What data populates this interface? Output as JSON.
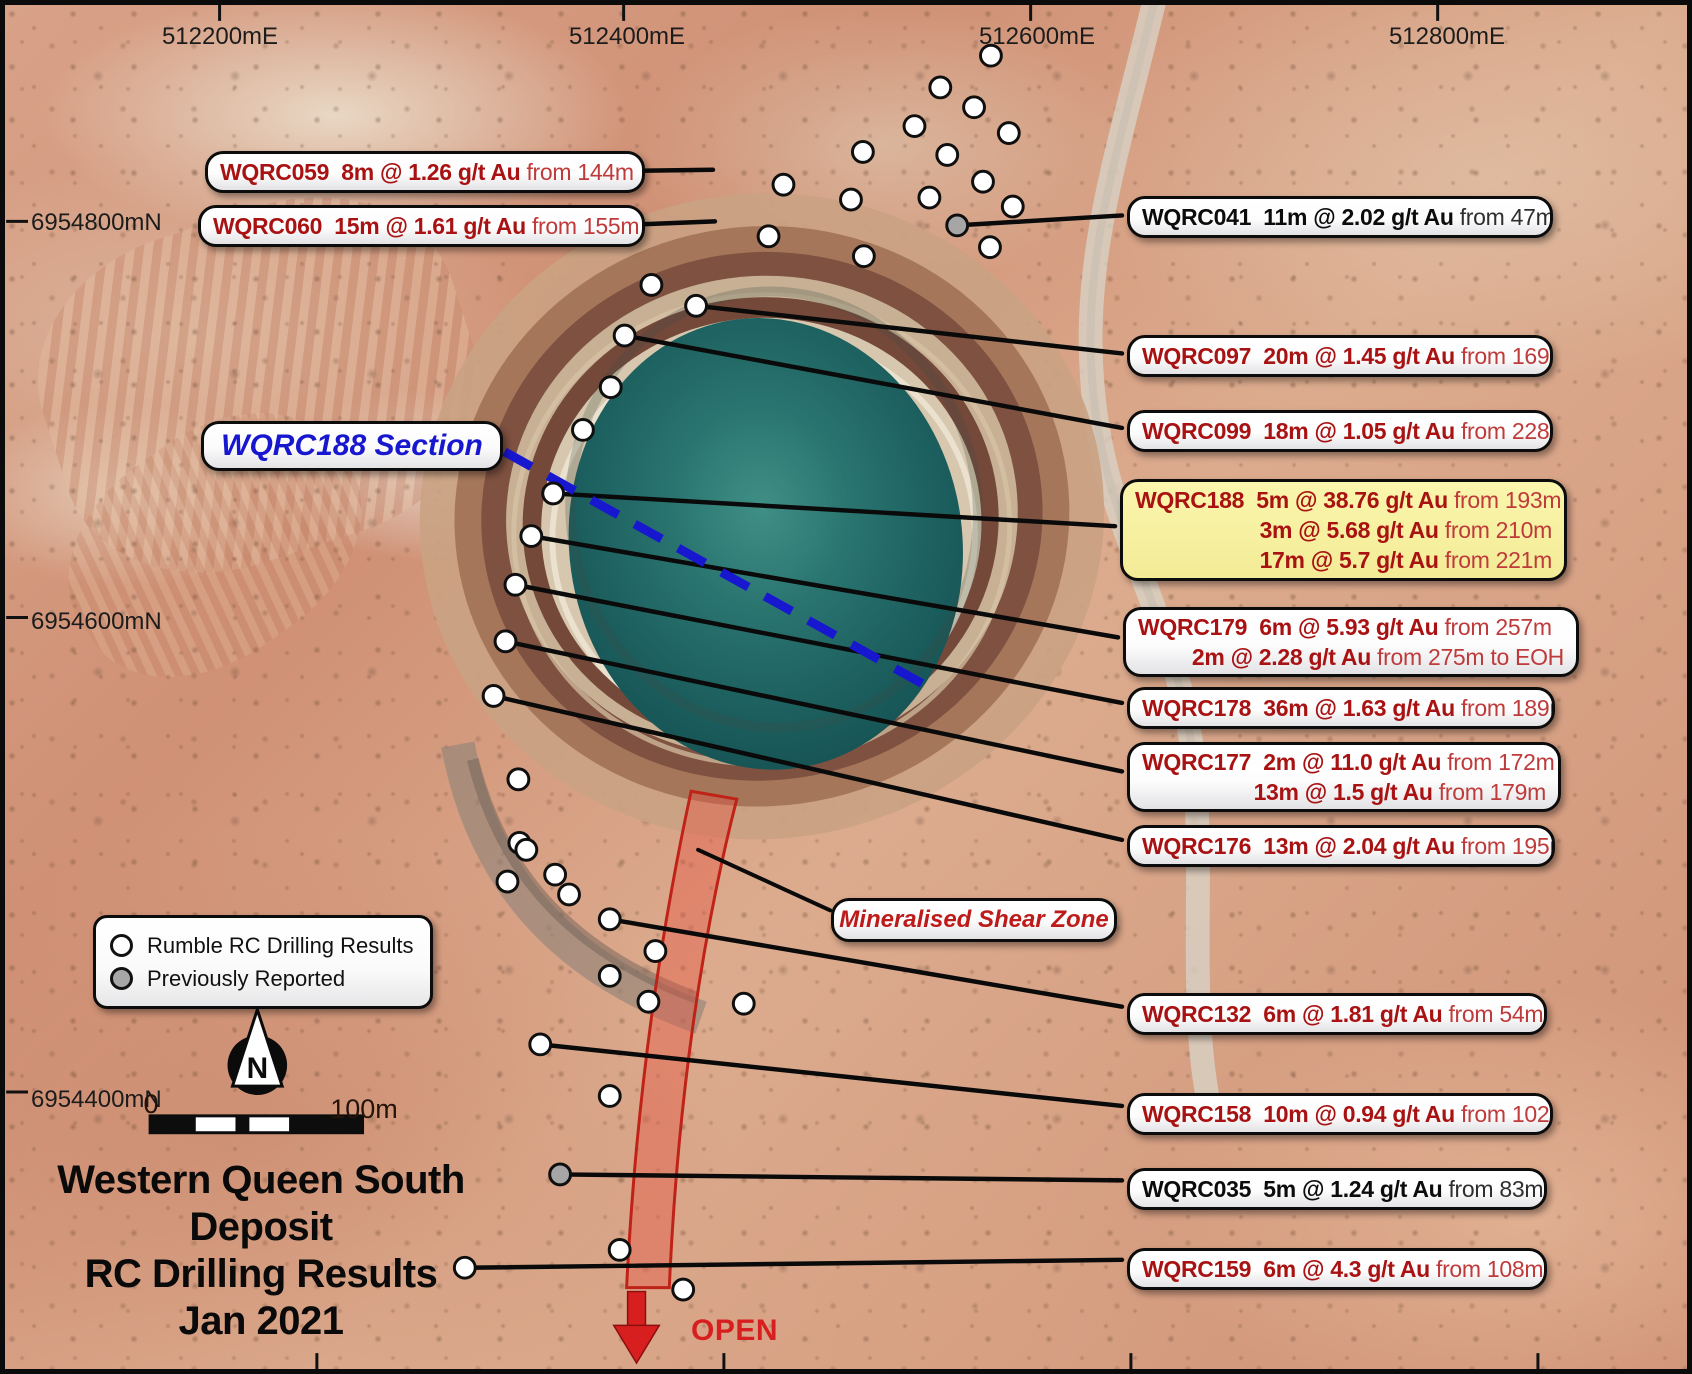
{
  "figure": {
    "title_lines": [
      "Western Queen South",
      "Deposit",
      "RC Drilling Results",
      "Jan 2021"
    ],
    "section_label": "WQRC188 Section",
    "shear_label": "Mineralised Shear Zone",
    "open_label": "OPEN",
    "north_label": "N",
    "scale_bar": {
      "zero": "0",
      "hundred": "100m"
    }
  },
  "legend": {
    "items": [
      {
        "label": "Rumble RC Drilling Results",
        "marker": "white"
      },
      {
        "label": "Previously Reported",
        "marker": "gray"
      }
    ]
  },
  "grid": {
    "top_labels": [
      {
        "text": "512200mE",
        "x": 215
      },
      {
        "text": "512400mE",
        "x": 622
      },
      {
        "text": "512600mE",
        "x": 1032
      },
      {
        "text": "512800mE",
        "x": 1442
      }
    ],
    "left_labels": [
      {
        "text": "6954800mN",
        "y": 218
      },
      {
        "text": "6954600mN",
        "y": 617
      },
      {
        "text": "6954400mN",
        "y": 1095
      }
    ],
    "bottom_ticks_x": [
      313,
      723,
      1133,
      1543
    ]
  },
  "colors": {
    "result_red": "#a91212",
    "previously_reported_black": "#0c0c0c",
    "highlight_yellow": "#f8f2a2",
    "section_blue": "#1717d0",
    "shear_red": "#d81f1f",
    "leader_black": "#0a0a0a"
  },
  "section_line": {
    "from": [
      502,
      450
    ],
    "to": [
      938,
      692
    ]
  },
  "callouts": [
    {
      "id": "WQRC059",
      "side": "left",
      "x": 200,
      "y": 146,
      "w": 440,
      "h": 42,
      "color": "red",
      "bg": "white",
      "anchor": [
        712,
        166
      ],
      "rows": [
        {
          "strong": "WQRC059  8m @ 1.26 g/t Au",
          "rest": " from 144m"
        }
      ]
    },
    {
      "id": "WQRC060",
      "side": "left",
      "x": 193,
      "y": 200,
      "w": 447,
      "h": 42,
      "color": "red",
      "bg": "white",
      "anchor": [
        714,
        218
      ],
      "rows": [
        {
          "strong": "WQRC060  15m @ 1.61 g/t Au",
          "rest": " from 155m"
        }
      ]
    },
    {
      "id": "WQRC041",
      "side": "right",
      "x": 1122,
      "y": 191,
      "w": 426,
      "h": 42,
      "color": "black",
      "bg": "white",
      "anchor": [
        958,
        222
      ],
      "rows": [
        {
          "strong": "WQRC041  11m @ 2.02 g/t Au",
          "rest": " from 47m"
        }
      ]
    },
    {
      "id": "WQRC097",
      "side": "right",
      "x": 1122,
      "y": 330,
      "w": 426,
      "h": 42,
      "color": "red",
      "bg": "white",
      "anchor": [
        695,
        303
      ],
      "rows": [
        {
          "strong": "WQRC097  20m @ 1.45 g/t Au",
          "rest": " from 169m"
        }
      ]
    },
    {
      "id": "WQRC099",
      "side": "right",
      "x": 1122,
      "y": 405,
      "w": 426,
      "h": 42,
      "color": "red",
      "bg": "white",
      "anchor": [
        623,
        333
      ],
      "rows": [
        {
          "strong": "WQRC099  18m @ 1.05 g/t Au",
          "rest": " from 228m"
        }
      ]
    },
    {
      "id": "WQRC188",
      "side": "right",
      "x": 1115,
      "y": 474,
      "w": 447,
      "h": 102,
      "color": "red",
      "bg": "yellow",
      "anchor": [
        551,
        492
      ],
      "rows": [
        {
          "strong": "WQRC188  5m @ 38.76 g/t Au",
          "rest": " from 193m"
        },
        {
          "strong": "3m @ 5.68 g/t Au",
          "rest": " from 210m"
        },
        {
          "strong": "17m @ 5.7 g/t Au",
          "rest": " from 221m"
        }
      ]
    },
    {
      "id": "WQRC179",
      "side": "right",
      "x": 1118,
      "y": 602,
      "w": 456,
      "h": 70,
      "color": "red",
      "bg": "white",
      "anchor": [
        529,
        535
      ],
      "rows": [
        {
          "strong": "WQRC179  6m @ 5.93 g/t Au",
          "rest": " from 257m"
        },
        {
          "strong": "2m @ 2.28 g/t Au",
          "rest": " from 275m to EOH"
        }
      ]
    },
    {
      "id": "WQRC178",
      "side": "right",
      "x": 1122,
      "y": 682,
      "w": 428,
      "h": 42,
      "color": "red",
      "bg": "white",
      "anchor": [
        513,
        584
      ],
      "rows": [
        {
          "strong": "WQRC178  36m @ 1.63 g/t Au",
          "rest": " from 189m"
        }
      ]
    },
    {
      "id": "WQRC177",
      "side": "right",
      "x": 1122,
      "y": 737,
      "w": 434,
      "h": 70,
      "color": "red",
      "bg": "white",
      "anchor": [
        503,
        641
      ],
      "rows": [
        {
          "strong": "WQRC177  2m @ 11.0 g/t Au",
          "rest": " from 172m"
        },
        {
          "strong": "13m @ 1.5 g/t Au",
          "rest": " from 179m"
        }
      ]
    },
    {
      "id": "WQRC176",
      "side": "right",
      "x": 1122,
      "y": 820,
      "w": 428,
      "h": 42,
      "color": "red",
      "bg": "white",
      "anchor": [
        491,
        696
      ],
      "rows": [
        {
          "strong": "WQRC176  13m @ 2.04 g/t Au",
          "rest": " from 195m"
        }
      ]
    },
    {
      "id": "WQRC132",
      "side": "right",
      "x": 1122,
      "y": 988,
      "w": 420,
      "h": 42,
      "color": "red",
      "bg": "white",
      "anchor": [
        608,
        921
      ],
      "rows": [
        {
          "strong": "WQRC132  6m @ 1.81 g/t Au",
          "rest": " from 54m"
        }
      ]
    },
    {
      "id": "WQRC158",
      "side": "right",
      "x": 1122,
      "y": 1088,
      "w": 426,
      "h": 42,
      "color": "red",
      "bg": "white",
      "anchor": [
        538,
        1047
      ],
      "rows": [
        {
          "strong": "WQRC158  10m @ 0.94 g/t Au",
          "rest": " from 102m"
        }
      ]
    },
    {
      "id": "WQRC035",
      "side": "right",
      "x": 1122,
      "y": 1163,
      "w": 420,
      "h": 42,
      "color": "black",
      "bg": "white",
      "anchor": [
        558,
        1178
      ],
      "rows": [
        {
          "strong": "WQRC035  5m @ 1.24 g/t Au",
          "rest": " from 83m"
        }
      ]
    },
    {
      "id": "WQRC159",
      "side": "right",
      "x": 1122,
      "y": 1243,
      "w": 420,
      "h": 42,
      "color": "red",
      "bg": "white",
      "anchor": [
        462,
        1272
      ],
      "rows": [
        {
          "strong": "WQRC159  6m @ 4.3 g/t Au",
          "rest": " from 108m"
        }
      ]
    }
  ],
  "shear_leader": {
    "from": [
      830,
      912
    ],
    "to": [
      697,
      851
    ]
  },
  "holes": {
    "white": [
      [
        992,
        51
      ],
      [
        941,
        83
      ],
      [
        975,
        103
      ],
      [
        915,
        122
      ],
      [
        1010,
        129
      ],
      [
        863,
        148
      ],
      [
        948,
        151
      ],
      [
        783,
        181
      ],
      [
        984,
        178
      ],
      [
        851,
        196
      ],
      [
        930,
        194
      ],
      [
        1014,
        203
      ],
      [
        768,
        233
      ],
      [
        991,
        244
      ],
      [
        864,
        253
      ],
      [
        650,
        282
      ],
      [
        695,
        303
      ],
      [
        623,
        333
      ],
      [
        609,
        385
      ],
      [
        581,
        428
      ],
      [
        551,
        492
      ],
      [
        529,
        535
      ],
      [
        513,
        584
      ],
      [
        503,
        641
      ],
      [
        491,
        696
      ],
      [
        516,
        780
      ],
      [
        517,
        844
      ],
      [
        524,
        851
      ],
      [
        505,
        883
      ],
      [
        553,
        876
      ],
      [
        567,
        896
      ],
      [
        608,
        921
      ],
      [
        654,
        953
      ],
      [
        608,
        978
      ],
      [
        647,
        1004
      ],
      [
        743,
        1006
      ],
      [
        538,
        1047
      ],
      [
        608,
        1099
      ],
      [
        618,
        1254
      ],
      [
        682,
        1294
      ],
      [
        462,
        1272
      ]
    ],
    "gray": [
      [
        958,
        222
      ],
      [
        558,
        1178
      ]
    ]
  }
}
